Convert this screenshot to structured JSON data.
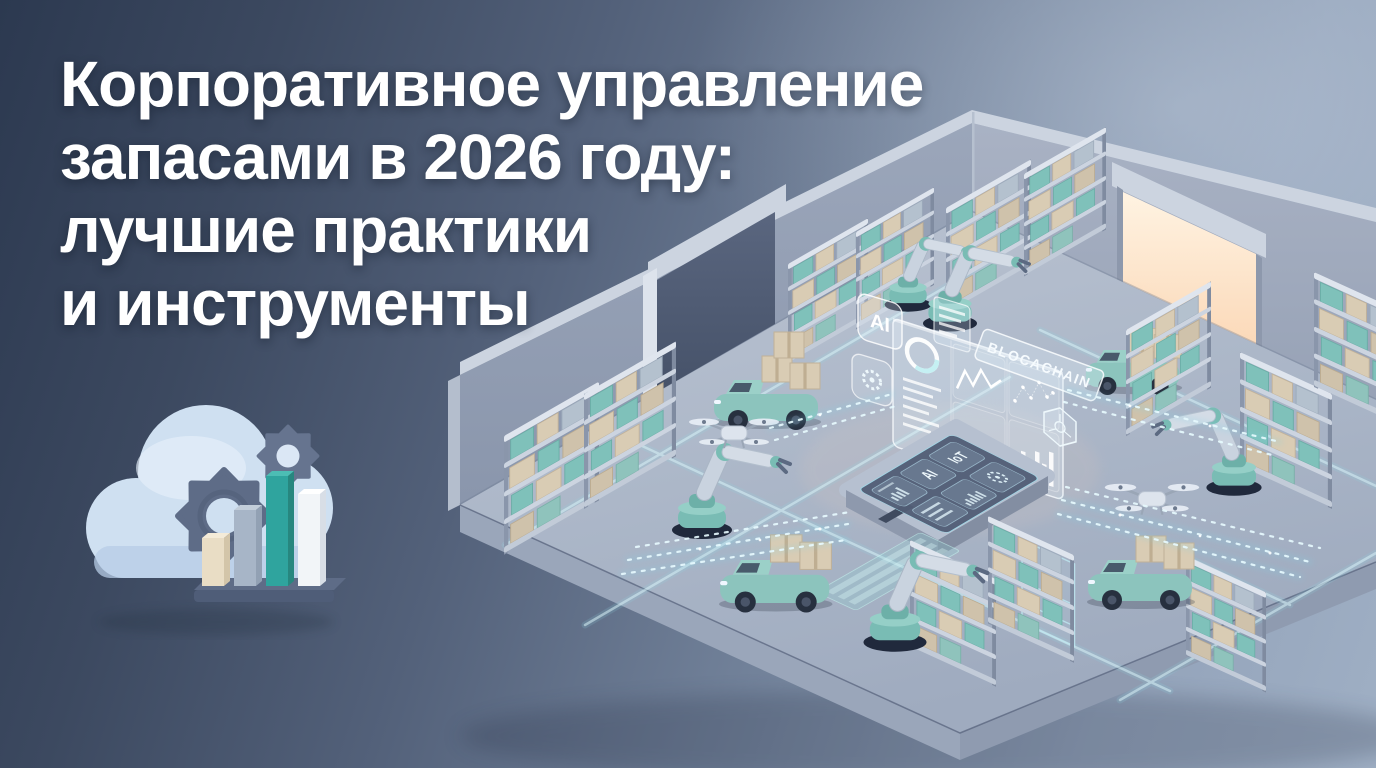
{
  "canvas": {
    "width": 1376,
    "height": 768
  },
  "title": {
    "lines": [
      "Корпоративное управление",
      "запасами в 2026 году:",
      "лучшие практики",
      "и инструменты"
    ],
    "color": "#ffffff"
  },
  "labels": {
    "wall_badge_ai": "AI",
    "tablet_tile_ai": "AI",
    "tablet_tile_iot": "IoT",
    "banner_blockchain": "BLOCACHAIN"
  },
  "icons": {
    "cloud_analytics_icon": "cloud with two gears and 3D bar chart",
    "gear_badge_icon": "gear",
    "hexagon_badge_icon": "hexagon network node",
    "ring_gauge_icon": "donut gauge",
    "drone_icon": "quadcopter drone",
    "robot_arm_icon": "robotic arm",
    "agv_icon": "autonomous delivery vehicle with boxes"
  },
  "colors": {
    "background_top_left": "#2c3950",
    "background_bottom_right": "#9fafc4",
    "title_text": "#ffffff",
    "cloud": "#cfe0f1",
    "gear": "#5e6c87",
    "bar_beige": "#e9ddc5",
    "bar_gray": "#a7b5c7",
    "bar_teal": "#2fa49e",
    "bar_white": "#f2f5f8",
    "accent_teal": "#8cc4bd",
    "floor": "#aab5c7",
    "wall": "#96a2b6",
    "box_beige": "#d9ccb4",
    "box_teal": "#7fc1ba",
    "glow_cyan": "#d9f2f8",
    "dock_warm": "#ffdcb8"
  },
  "scene": {
    "style": "isometric 3D smart warehouse render",
    "elements": [
      "warehouse room with two walls",
      "dark roll-up door",
      "loading dock with warm light",
      "storage shelves with teal and beige boxes",
      "robotic arms",
      "autonomous delivery vehicles carrying boxes",
      "quadcopter drones",
      "central control tablet",
      "holographic analytics dashboard",
      "glowing data streams and floor lanes"
    ]
  },
  "dashboard_widgets": [
    "ring-gauge",
    "kpi-text-list",
    "line-chart",
    "area-chart",
    "network-scatter",
    "bar-chart"
  ],
  "tablet_tiles": [
    "mini-bar-chart",
    "AI",
    "IoT",
    "text-lines",
    "waveform",
    "gear"
  ]
}
